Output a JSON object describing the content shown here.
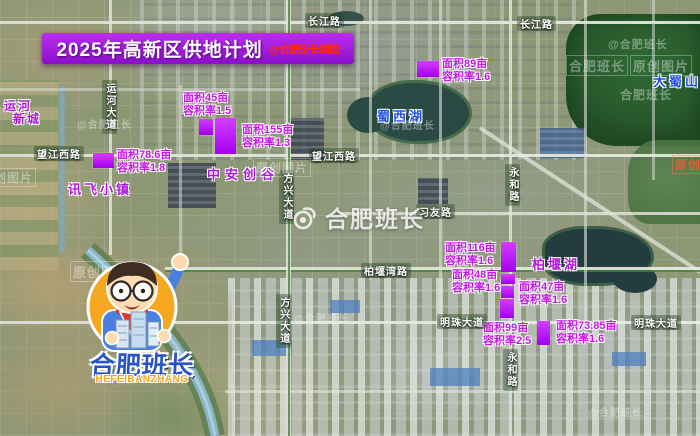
{
  "title": {
    "text": "2025年高新区供地计划",
    "credit": "@合肥班长制图"
  },
  "plots": [
    {
      "area": "面积45亩",
      "far": "容积率1.5"
    },
    {
      "area": "面积155亩",
      "far": "容积率1.3"
    },
    {
      "area": "面积78.6亩",
      "far": "容积率1.8"
    },
    {
      "area": "面积89亩",
      "far": "容积率1.6"
    },
    {
      "area": "面积116亩",
      "far": "容积率1.6"
    },
    {
      "area": "面积48亩",
      "far": "容积率1.6"
    },
    {
      "area": "面积47亩",
      "far": "容积率1.6"
    },
    {
      "area": "面积99亩",
      "far": "容积率2.5"
    },
    {
      "area": "面积73.85亩",
      "far": "容积率1.6"
    }
  ],
  "roads": {
    "changjiang": "长江路",
    "wangjiangxi": "望江西路",
    "yunhe_dadao": "运河大道",
    "fangxing_dadao": "方兴大道",
    "xiyou": "习友路",
    "yonghe": "永和路",
    "baiyanwan": "柏堰湾路",
    "mingzhu_dadao": "明珠大道"
  },
  "places": {
    "yunhe_newtown_line1": "运河",
    "yunhe_newtown_line2": "新城",
    "xunfei_town": "讯飞小镇",
    "zhongan_chuanggu": "中安创谷",
    "shuxi_lake": "蜀西湖",
    "baiyan_lake": "柏堰湖",
    "dashu_mountain": "大蜀山"
  },
  "watermarks": {
    "handle": "@合肥班长",
    "name": "合肥班长",
    "original": "原创图片"
  },
  "mascot": {
    "name_cn": "合肥班长",
    "name_en": "HEFEIBANZHANG"
  },
  "colors": {
    "banner_purple": "#a21fe0",
    "plot_text_magenta": "#c517e8",
    "marker_purple": "#bb00ff",
    "place_purple": "#ab18d8",
    "lake_label_blue": "#1c50e0",
    "credit_red": "#ff2a00",
    "logo_blue": "#2853c8",
    "logo_yellow": "#f2a71f"
  }
}
